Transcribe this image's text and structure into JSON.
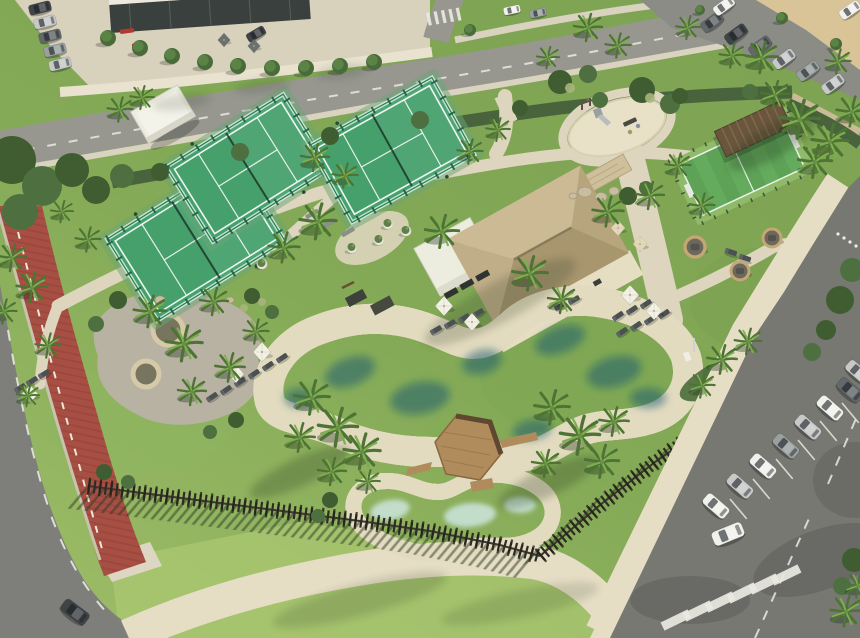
{
  "meta": {
    "description": "Aerial drone view of a resort amenity park: free-form lagoon swimming pool with wooden deck island, kids pool, thatched-roof bar pavilion, three padel courts, multisport turf court, playground, wicker seating pods, palm trees, red running track, perimeter timber fence, streets and parking lots with cars"
  },
  "colors": {
    "grass_hi": "#a6c36c",
    "grass": "#84aa57",
    "grass_dk": "#6b924a",
    "lawn_bright": "#abc771",
    "hedge": "#49643c",
    "shrub_dk": "#3f5d31",
    "shrub_md": "#4e7040",
    "palm_dk": "#4d7434",
    "palm_lt": "#7fae4e",
    "path": "#ddd5bd",
    "path_bright": "#e7dfc7",
    "promenade": "#e5ddc4",
    "road_top": "#97978f",
    "road_dk": "#7e7f7a",
    "asphalt": "#787873",
    "asphalt_shade": "#5f605b",
    "track": "#a84f44",
    "track_dk": "#8f4038",
    "sand_lot": "#d9c498",
    "beach": "#d7caa3",
    "deck": "#e3dbbf",
    "pool_deep": "#135f7b",
    "pool_mid": "#2d93ad",
    "pool_lt": "#52b4c6",
    "kids": "#aed8da",
    "kids_lt": "#cfe9e6",
    "thatch_n": "#ccba94",
    "thatch_s": "#a8966f",
    "thatch_w": "#c0ae88",
    "thatch_e": "#b7a57d",
    "ridge": "#8a7a5c",
    "white_bldg": "#ececdf",
    "stone": "#cfc09c",
    "court": "#46a06c",
    "court_frame": "#2f7b55",
    "turf": "#5da257",
    "turf_lt": "#69b061",
    "turf_pale": "#8fba6a",
    "wood": "#b08b5c",
    "wood_dk": "#5f4730",
    "fence": "#2e2c24",
    "lounger": "#4b5053",
    "umb_white": "#f3f0e4",
    "umb_cream": "#e4d9b8",
    "umb_gray": "#6e7270",
    "car_white": "#f1f1ec",
    "car_silver": "#c7c9c8",
    "car_gray": "#9aa0a0",
    "car_graphite": "#63686a",
    "car_dark": "#3f4446",
    "line_white": "#e9e9e2",
    "bldg_dark": "#3a403d",
    "parapet": "#eceade",
    "pot": "#efece2",
    "olive": "#5f7f46",
    "wicker": "#c3a876",
    "gravel": "#b7b2a1",
    "planter_in": "#77745f",
    "bench_gray": "#8a8f89",
    "bench_red": "#b03a2e",
    "bench_dark": "#4a4a44",
    "slide": "#9aa0a2"
  },
  "scene": {
    "inventory": [
      "lagoon-pool",
      "kids-pool",
      "wood-deck-island",
      "bar-pavilion",
      "padel-courts",
      "multisport-court",
      "playground",
      "running-track",
      "perimeter-fence",
      "parking-lots",
      "seating-pods",
      "sun-loungers",
      "umbrellas",
      "palm-trees"
    ],
    "palms": [
      [
        588,
        28,
        1
      ],
      [
        618,
        46,
        0.9
      ],
      [
        688,
        28,
        0.85
      ],
      [
        732,
        56,
        0.9
      ],
      [
        762,
        58,
        1.15
      ],
      [
        775,
        95,
        1
      ],
      [
        800,
        120,
        1.4
      ],
      [
        830,
        142,
        1.3
      ],
      [
        852,
        112,
        1.1
      ],
      [
        815,
        162,
        1.2
      ],
      [
        838,
        62,
        0.9
      ],
      [
        548,
        58,
        0.8
      ],
      [
        120,
        110,
        0.9
      ],
      [
        142,
        98,
        0.85
      ],
      [
        315,
        158,
        1
      ],
      [
        345,
        176,
        0.9
      ],
      [
        470,
        152,
        0.9
      ],
      [
        498,
        130,
        0.85
      ],
      [
        318,
        222,
        1.3
      ],
      [
        284,
        248,
        1.1
      ],
      [
        12,
        258,
        1
      ],
      [
        32,
        288,
        1.1
      ],
      [
        88,
        240,
        0.9
      ],
      [
        62,
        212,
        0.8
      ],
      [
        4,
        312,
        0.9
      ],
      [
        150,
        312,
        1.15
      ],
      [
        184,
        344,
        1.3
      ],
      [
        214,
        302,
        1
      ],
      [
        230,
        368,
        1.05
      ],
      [
        192,
        392,
        1
      ],
      [
        256,
        332,
        0.9
      ],
      [
        48,
        346,
        0.9
      ],
      [
        28,
        396,
        0.8
      ],
      [
        442,
        232,
        1.2
      ],
      [
        530,
        274,
        1.25
      ],
      [
        562,
        300,
        1
      ],
      [
        608,
        212,
        1.1
      ],
      [
        650,
        196,
        1
      ],
      [
        678,
        166,
        0.9
      ],
      [
        702,
        206,
        0.9
      ],
      [
        312,
        398,
        1.25
      ],
      [
        338,
        428,
        1.4
      ],
      [
        362,
        452,
        1.3
      ],
      [
        300,
        438,
        1.05
      ],
      [
        332,
        472,
        1
      ],
      [
        552,
        408,
        1.25
      ],
      [
        580,
        436,
        1.4
      ],
      [
        602,
        462,
        1.2
      ],
      [
        546,
        464,
        1
      ],
      [
        614,
        422,
        1.05
      ],
      [
        722,
        360,
        1.05
      ],
      [
        748,
        342,
        0.95
      ],
      [
        702,
        386,
        0.9
      ],
      [
        846,
        612,
        1.1
      ],
      [
        858,
        586,
        0.9
      ],
      [
        368,
        482,
        0.85
      ]
    ],
    "trees": [
      [
        108,
        38,
        8
      ],
      [
        140,
        48,
        8
      ],
      [
        172,
        56,
        8
      ],
      [
        205,
        62,
        8
      ],
      [
        238,
        66,
        8
      ],
      [
        272,
        68,
        8
      ],
      [
        306,
        68,
        8
      ],
      [
        340,
        66,
        8
      ],
      [
        374,
        62,
        8
      ],
      [
        470,
        30,
        6
      ],
      [
        782,
        18,
        6
      ],
      [
        836,
        44,
        6
      ],
      [
        700,
        10,
        5
      ]
    ],
    "shrubs": [
      [
        12,
        160,
        24
      ],
      [
        42,
        186,
        20
      ],
      [
        72,
        170,
        17
      ],
      [
        20,
        212,
        18
      ],
      [
        96,
        190,
        14
      ],
      [
        122,
        176,
        12
      ],
      [
        560,
        82,
        12
      ],
      [
        588,
        74,
        9
      ],
      [
        642,
        90,
        13
      ],
      [
        670,
        104,
        10
      ],
      [
        628,
        196,
        9
      ],
      [
        646,
        188,
        7
      ],
      [
        160,
        172,
        9
      ],
      [
        240,
        152,
        9
      ],
      [
        330,
        136,
        9
      ],
      [
        420,
        120,
        9
      ],
      [
        520,
        108,
        8
      ],
      [
        600,
        100,
        8
      ],
      [
        680,
        96,
        8
      ],
      [
        750,
        92,
        8
      ],
      [
        840,
        300,
        14
      ],
      [
        852,
        270,
        12
      ],
      [
        826,
        330,
        10
      ],
      [
        812,
        352,
        9
      ],
      [
        118,
        300,
        9
      ],
      [
        96,
        324,
        8
      ],
      [
        252,
        296,
        8
      ],
      [
        272,
        312,
        7
      ],
      [
        236,
        420,
        8
      ],
      [
        210,
        432,
        7
      ],
      [
        104,
        472,
        8
      ],
      [
        128,
        482,
        7
      ],
      [
        854,
        560,
        12
      ],
      [
        842,
        586,
        9
      ],
      [
        330,
        500,
        8
      ],
      [
        318,
        516,
        7
      ]
    ],
    "flowers": [
      [
        570,
        88,
        5
      ],
      [
        650,
        98,
        5
      ],
      [
        262,
        302,
        4
      ],
      [
        244,
        308,
        4
      ]
    ],
    "cars_top": [
      [
        40,
        8,
        -14,
        0.8,
        "dark"
      ],
      [
        45,
        22,
        -14,
        0.8,
        "silver"
      ],
      [
        50,
        36,
        -14,
        0.8,
        "graphite"
      ],
      [
        55,
        50,
        -14,
        0.8,
        "gray"
      ],
      [
        60,
        64,
        -14,
        0.8,
        "silver"
      ],
      [
        256,
        34,
        -30,
        0.7,
        "dark"
      ],
      [
        512,
        10,
        -12,
        0.6,
        "white"
      ],
      [
        538,
        13,
        -12,
        0.6,
        "gray"
      ],
      [
        850,
        10,
        -35,
        0.8,
        "white"
      ],
      [
        712,
        22,
        -36,
        0.85,
        "graphite"
      ],
      [
        736,
        34,
        -36,
        0.85,
        "dark"
      ],
      [
        760,
        46,
        -36,
        0.85,
        "graphite"
      ],
      [
        784,
        59,
        -36,
        0.85,
        "silver"
      ],
      [
        808,
        71,
        -36,
        0.85,
        "gray"
      ],
      [
        833,
        84,
        -36,
        0.85,
        "silver"
      ],
      [
        724,
        6,
        -36,
        0.8,
        "white"
      ],
      [
        75,
        612,
        37,
        1.05,
        "dark"
      ]
    ],
    "cars_park": [
      [
        716,
        506,
        41,
        1,
        "white"
      ],
      [
        740,
        486,
        41,
        1,
        "silver"
      ],
      [
        763,
        466,
        41,
        1,
        "white"
      ],
      [
        786,
        446,
        41,
        1,
        "gray"
      ],
      [
        808,
        427,
        41,
        1,
        "silver"
      ],
      [
        830,
        408,
        41,
        1,
        "white"
      ],
      [
        850,
        390,
        41,
        1,
        "graphite"
      ],
      [
        858,
        372,
        41,
        0.95,
        "silver"
      ],
      [
        728,
        534,
        -22,
        1.15,
        "white"
      ]
    ],
    "loungers": [
      [
        20,
        388,
        -32
      ],
      [
        32,
        381,
        -32
      ],
      [
        44,
        374,
        -32
      ],
      [
        226,
        390,
        -34
      ],
      [
        240,
        382,
        -34
      ],
      [
        254,
        374,
        -34
      ],
      [
        268,
        366,
        -34
      ],
      [
        282,
        358,
        -34
      ],
      [
        212,
        397,
        -34
      ],
      [
        436,
        330,
        -30
      ],
      [
        450,
        324,
        -30
      ],
      [
        464,
        318,
        -30
      ],
      [
        478,
        313,
        -30
      ],
      [
        618,
        316,
        -34
      ],
      [
        632,
        310,
        -34
      ],
      [
        646,
        304,
        -34
      ],
      [
        622,
        332,
        -34
      ],
      [
        636,
        326,
        -34
      ],
      [
        650,
        320,
        -34
      ],
      [
        664,
        314,
        -34
      ],
      [
        731,
        252,
        18
      ],
      [
        745,
        258,
        18
      ],
      [
        560,
        306,
        -30
      ],
      [
        574,
        300,
        -30
      ]
    ],
    "umbrellas": [
      [
        262,
        352,
        1,
        "white"
      ],
      [
        236,
        374,
        0.9,
        "white"
      ],
      [
        30,
        394,
        0.9,
        "white"
      ],
      [
        444,
        306,
        1,
        "white"
      ],
      [
        472,
        322,
        0.9,
        "white"
      ],
      [
        630,
        295,
        1,
        "white"
      ],
      [
        654,
        311,
        0.9,
        "white"
      ],
      [
        618,
        228,
        0.8,
        "cream"
      ],
      [
        640,
        244,
        0.8,
        "cream"
      ],
      [
        224,
        40,
        0.7,
        "gray"
      ],
      [
        254,
        46,
        0.7,
        "gray"
      ]
    ],
    "pods": [
      [
        695,
        247,
        10
      ],
      [
        772,
        238,
        9
      ],
      [
        740,
        271,
        9
      ]
    ],
    "pots": [
      [
        352,
        248
      ],
      [
        379,
        240
      ],
      [
        406,
        231
      ],
      [
        262,
        264
      ],
      [
        388,
        224
      ]
    ],
    "benches": [
      [
        312,
        214,
        -30,
        "gray"
      ],
      [
        330,
        223,
        -30,
        "gray"
      ],
      [
        348,
        232,
        -30,
        "gray"
      ],
      [
        127,
        31,
        -8,
        "red"
      ],
      [
        139,
        45,
        -8,
        "red"
      ],
      [
        630,
        122,
        -25,
        "dark"
      ]
    ],
    "boulders": [
      [
        585,
        192,
        7,
        5
      ],
      [
        601,
        197,
        6,
        4.5
      ],
      [
        614,
        191,
        5,
        4
      ],
      [
        573,
        196,
        4,
        3
      ],
      [
        160,
        300,
        5,
        4
      ],
      [
        230,
        300,
        4,
        3
      ]
    ],
    "bollards": [
      [
        838,
        234
      ],
      [
        844,
        238
      ],
      [
        850,
        242
      ],
      [
        856,
        246
      ]
    ],
    "courts": [
      {
        "x": 196,
        "y": 240,
        "r": -32,
        "w": 150,
        "h": 96
      },
      {
        "x": 248,
        "y": 168,
        "r": -32,
        "w": 138,
        "h": 88
      },
      {
        "x": 392,
        "y": 150,
        "r": -29,
        "w": 140,
        "h": 88
      }
    ],
    "fence": {
      "line1": [
        [
          88,
          486
        ],
        [
          150,
          494
        ],
        [
          220,
          503
        ],
        [
          290,
          512
        ],
        [
          360,
          521
        ],
        [
          430,
          531
        ],
        [
          500,
          545
        ],
        [
          540,
          556
        ]
      ],
      "line2": [
        [
          540,
          556
        ],
        [
          600,
          505
        ],
        [
          655,
          462
        ],
        [
          710,
          424
        ],
        [
          765,
          396
        ],
        [
          820,
          368
        ],
        [
          858,
          348
        ]
      ],
      "shadow1": [
        -24,
        22
      ],
      "shadow2": [
        -30,
        16
      ]
    },
    "zebra_main": {
      "start": [
        676,
        620
      ],
      "step": [
        22,
        -9
      ],
      "count": 6,
      "w": 9,
      "l": 30,
      "rot": 64
    },
    "zebra_top": {
      "start": [
        429,
        19
      ],
      "step": [
        7.4,
        -1.2
      ],
      "count": 5,
      "w": 3.2,
      "l": 13,
      "rot": -12
    },
    "stalls": {
      "pts": [
        [
          730,
          499
        ],
        [
          753,
          479
        ],
        [
          776,
          459
        ],
        [
          798,
          440
        ],
        [
          820,
          421
        ],
        [
          842,
          403
        ]
      ],
      "angle": 50,
      "len": 26
    },
    "park_dashes": [
      "M755,638 L812,512",
      "M828,484 L858,414"
    ],
    "water_blobs": [
      [
        350,
        372,
        26,
        14,
        -20
      ],
      [
        420,
        398,
        30,
        16,
        -10
      ],
      [
        482,
        362,
        20,
        12,
        -15
      ],
      [
        560,
        340,
        26,
        13,
        -20
      ],
      [
        614,
        372,
        28,
        15,
        -15
      ],
      [
        648,
        398,
        18,
        10,
        0
      ],
      [
        300,
        398,
        16,
        10,
        0
      ],
      [
        532,
        430,
        20,
        10,
        -10
      ]
    ],
    "kids_blobs": [
      [
        390,
        510,
        20,
        10,
        -10
      ],
      [
        470,
        515,
        26,
        12,
        -5
      ],
      [
        520,
        505,
        16,
        8,
        0
      ]
    ],
    "shadow_blobs": [
      [
        500,
        302,
        85,
        20,
        -28,
        0.2
      ],
      [
        300,
        472,
        55,
        14,
        -25,
        0.25
      ],
      [
        548,
        482,
        55,
        14,
        -25,
        0.25
      ],
      [
        772,
        142,
        50,
        16,
        -30,
        0.28
      ],
      [
        360,
        600,
        90,
        16,
        -15,
        0.16
      ],
      [
        520,
        604,
        80,
        14,
        -12,
        0.14
      ],
      [
        182,
        102,
        30,
        8,
        -8,
        0.14
      ],
      [
        262,
        86,
        28,
        7,
        -8,
        0.14
      ],
      [
        342,
        72,
        26,
        7,
        -8,
        0.14
      ]
    ]
  }
}
